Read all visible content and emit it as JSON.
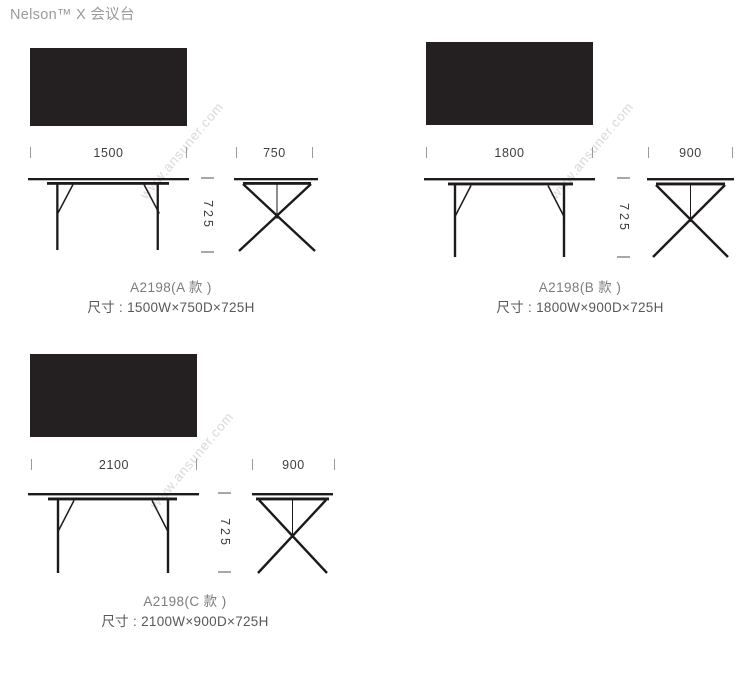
{
  "page": {
    "title": "Nelson™ X 会议台",
    "watermark": "www.ansuner.com"
  },
  "colors": {
    "paper": "#ffffff",
    "ink": "#1d1a1b",
    "top-fill": "#241f20",
    "dim-text": "#3e3e3e",
    "tick": "#9b9b9b",
    "dash": "#a8a8a8",
    "title": "#9a9a9a",
    "model-text": "#7c7c7c",
    "size-text": "#585858",
    "watermark": "#d9d9d9"
  },
  "panels": [
    {
      "variant": "A",
      "model_label": "A2198(A 款 )",
      "size_label": "尺寸 : 1500W×750D×725H",
      "width": "1500",
      "depth": "750",
      "height": "725"
    },
    {
      "variant": "B",
      "model_label": "A2198(B 款 )",
      "size_label": "尺寸 : 1800W×900D×725H",
      "width": "1800",
      "depth": "900",
      "height": "725"
    },
    {
      "variant": "C",
      "model_label": "A2198(C 款 )",
      "size_label": "尺寸 : 2100W×900D×725H",
      "width": "2100",
      "depth": "900",
      "height": "725"
    }
  ]
}
